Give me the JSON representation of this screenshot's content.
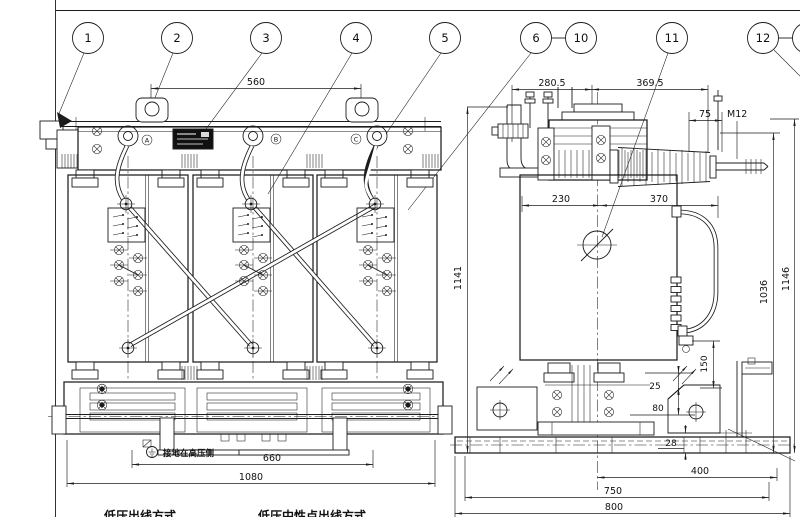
{
  "colors": {
    "line": "#1c1c1c",
    "background": "#ffffff"
  },
  "balloons": [
    {
      "label": "1"
    },
    {
      "label": "2"
    },
    {
      "label": "3"
    },
    {
      "label": "4"
    },
    {
      "label": "5"
    },
    {
      "label": "6"
    },
    {
      "label": "10"
    },
    {
      "label": "11"
    },
    {
      "label": "12"
    }
  ],
  "front_view": {
    "dim_lug_spacing": "560",
    "dim_jack_spacing": "660",
    "dim_overall_width": "1080",
    "phase_a": "A",
    "phase_b": "B",
    "phase_c": "C",
    "grounding_note": "接地在高压侧",
    "caption_lv": "低压出线方式",
    "caption_lv_neutral": "低压中性点出线方式"
  },
  "side_view": {
    "dim_top_left": "280.5",
    "dim_top_right": "369.5",
    "dim_stud_offset": "75",
    "thread_spec": "M12",
    "dim_body_left": "230",
    "dim_body_right": "370",
    "dim_height_front": "1141",
    "dim_height_stud": "1036",
    "dim_height_overall": "1146",
    "dim_jack_height": "150",
    "dim_offset_25": "25",
    "dim_offset_80": "80",
    "dim_offset_28": "28",
    "dim_base_400": "400",
    "dim_base_750": "750",
    "dim_base_800": "800"
  }
}
